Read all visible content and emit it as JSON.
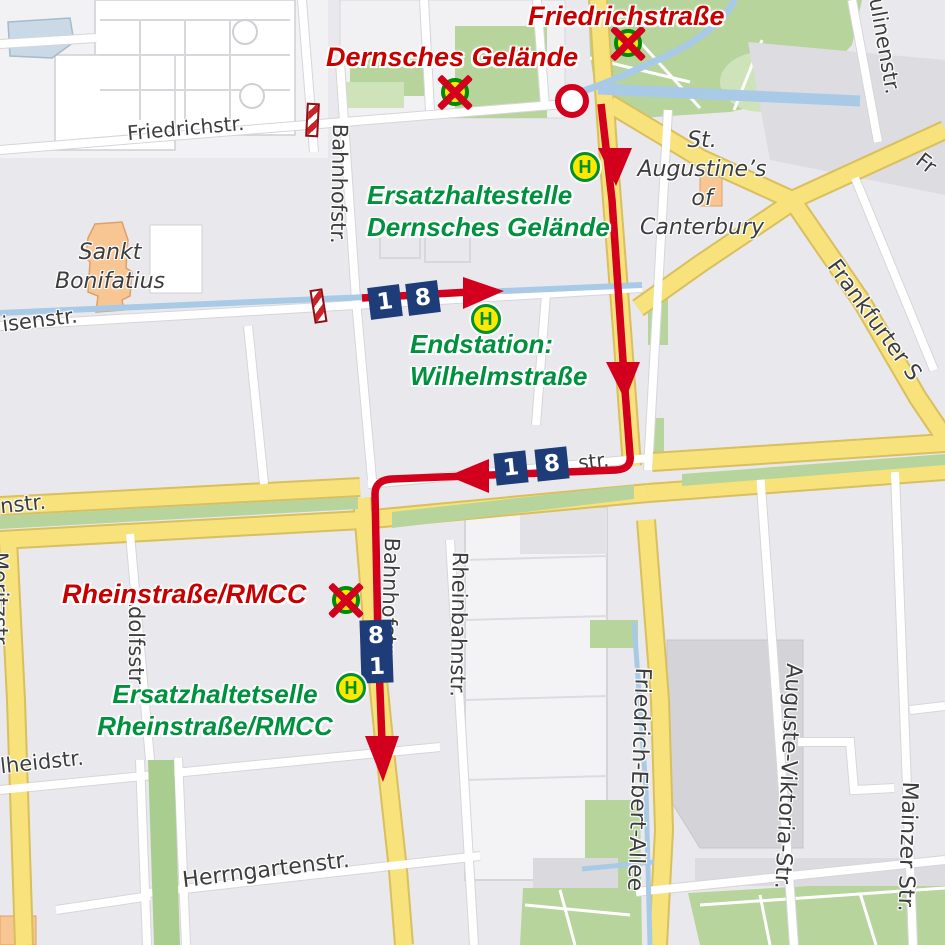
{
  "stops": {
    "h_letter": "H",
    "closed": [
      {
        "name": "Friedrichstraße"
      },
      {
        "name": "Dernsches Gelände"
      },
      {
        "name": "Rheinstraße/RMCC"
      }
    ],
    "replacement": [
      {
        "line1": "Ersatzhaltestelle",
        "line2": "Dernsches Gelände"
      },
      {
        "line1": "Endstation:",
        "line2": "Wilhelmstraße"
      },
      {
        "line1": "Ersatzhaltetselle",
        "line2": "Rheinstraße/RMCC"
      }
    ]
  },
  "route": {
    "line_numbers": [
      "1",
      "8"
    ]
  },
  "streets": {
    "friedrichstr": "Friedrichstr.",
    "bahnhofstr": "Bahnhofstr.",
    "luisenstr_fragment": "isenstr.",
    "rheinstr_fragment": "str.",
    "left_edge_fragment": "nstr.",
    "moritzstr": "Moritzstr.",
    "adolfsstr": "Adolfsstr.",
    "rheinbahnstr": "Rheinbahnstr.",
    "friedrich_ebert_allee": "Friedrich-Ebert-Allee",
    "auguste_viktoria_str": "Auguste-Viktoria-Str.",
    "mainzer_str": "Mainzer Str.",
    "adelheidstr_fragment": "lheidstr.",
    "herrngartenstr": "Herrngartenstr.",
    "paulinenstr_fragment": "ulinenstr.",
    "frankfurter_str_fragment": "Frankfurter S",
    "fr_fragment": "Fr"
  },
  "places": {
    "sankt_bonifatius": [
      "Sankt",
      "Bonifatius"
    ],
    "st_augustines": [
      "St.",
      "Augustine’s",
      "of",
      "Canterbury"
    ]
  },
  "colors": {
    "route_red": "#d2001c",
    "closed_label_red": "#c80000",
    "replacement_green": "#00913f",
    "line_badge_blue": "#1d3c78",
    "road_yellow": "#f7e27c",
    "park_green": "#b7d49c",
    "water_blue": "#a9cae6",
    "stop_yellow": "#ffe800",
    "stop_green": "#00912d"
  }
}
